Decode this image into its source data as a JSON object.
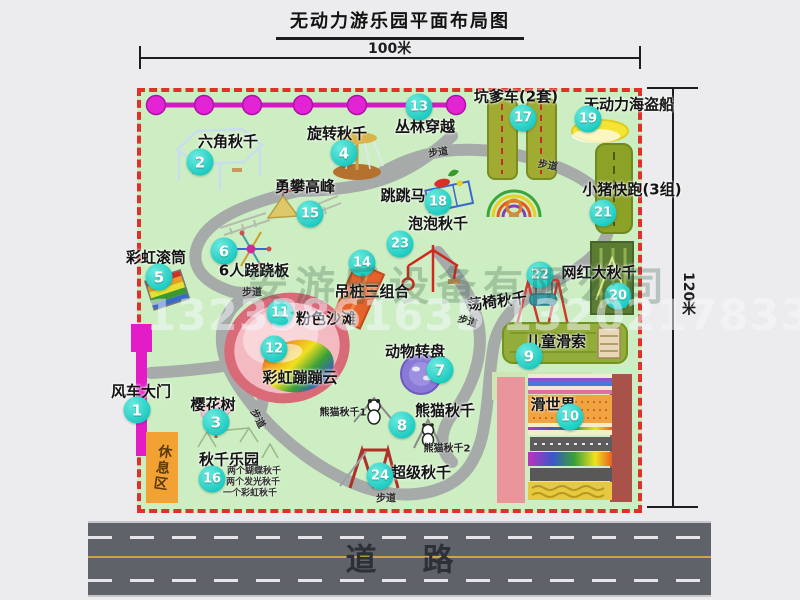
{
  "title": "无动力游乐园平面布局图",
  "dimensions": {
    "top": "100米",
    "right": "120米"
  },
  "road": {
    "label": "道路"
  },
  "rest_area": {
    "label": "休息区"
  },
  "watermark": {
    "company": "安游乐设备有限公司",
    "phones": "13233861635 13202178333"
  },
  "trail_label_text": "步道",
  "trail_labels": [
    {
      "x": 438,
      "y": 151,
      "rot": -8
    },
    {
      "x": 548,
      "y": 164,
      "rot": 10
    },
    {
      "x": 252,
      "y": 291,
      "rot": 0
    },
    {
      "x": 259,
      "y": 418,
      "rot": 62
    },
    {
      "x": 468,
      "y": 320,
      "rot": 18
    },
    {
      "x": 386,
      "y": 497,
      "rot": 0
    }
  ],
  "attractions": [
    {
      "num": "1",
      "label": "风车大门",
      "lx": 141,
      "ly": 391,
      "bx": 137,
      "by": 410
    },
    {
      "num": "2",
      "label": "六角秋千",
      "lx": 228,
      "ly": 141,
      "bx": 200,
      "by": 162
    },
    {
      "num": "3",
      "label": "樱花树",
      "lx": 213,
      "ly": 404,
      "bx": 216,
      "by": 422
    },
    {
      "num": "4",
      "label": "旋转秋千",
      "lx": 337,
      "ly": 133,
      "bx": 344,
      "by": 153
    },
    {
      "num": "5",
      "label": "彩虹滚筒",
      "lx": 156,
      "ly": 257,
      "bx": 159,
      "by": 277
    },
    {
      "num": "6",
      "label": "6人跷跷板",
      "lx": 254,
      "ly": 270,
      "bx": 224,
      "by": 251
    },
    {
      "num": "7",
      "label": "动物转盘",
      "lx": 415,
      "ly": 351,
      "bx": 440,
      "by": 370
    },
    {
      "num": "8",
      "label": "熊猫秋千",
      "lx": 445,
      "ly": 410,
      "bx": 402,
      "by": 425
    },
    {
      "num": "9",
      "label": "儿童滑索",
      "lx": 556,
      "ly": 341,
      "bx": 529,
      "by": 356
    },
    {
      "num": "10",
      "label": "滑世界",
      "lx": 553,
      "ly": 404,
      "bx": 570,
      "by": 417
    },
    {
      "num": "11",
      "label": "粉色沙滩",
      "lx": 326,
      "ly": 318,
      "bx": 280,
      "by": 313
    },
    {
      "num": "12",
      "label": "彩虹蹦蹦云",
      "lx": 300,
      "ly": 377,
      "bx": 274,
      "by": 349
    },
    {
      "num": "13",
      "label": "丛林穿越",
      "lx": 425,
      "ly": 126,
      "bx": 419,
      "by": 107
    },
    {
      "num": "14",
      "label": "吊桩三组合",
      "lx": 372,
      "ly": 291,
      "bx": 362,
      "by": 263
    },
    {
      "num": "15",
      "label": "勇攀高峰",
      "lx": 305,
      "ly": 186,
      "bx": 310,
      "by": 214
    },
    {
      "num": "16",
      "label": "秋千乐园",
      "lx": 229,
      "ly": 459,
      "bx": 212,
      "by": 479
    },
    {
      "num": "17",
      "label": "坑爹车(2套)",
      "lx": 516,
      "ly": 96,
      "bx": 523,
      "by": 118
    },
    {
      "num": "18",
      "label": "跳跳马",
      "lx": 403,
      "ly": 195,
      "bx": 438,
      "by": 202
    },
    {
      "num": "19",
      "label": "无动力海盗船",
      "lx": 629,
      "ly": 104,
      "bx": 588,
      "by": 119
    },
    {
      "num": "20",
      "label": "网红大秋千",
      "lx": 599,
      "ly": 272,
      "bx": 618,
      "by": 296
    },
    {
      "num": "21",
      "label": "小猪快跑(3组)",
      "lx": 632,
      "ly": 189,
      "bx": 603,
      "by": 213
    },
    {
      "num": "22",
      "label": "荡椅秋千",
      "lx": 497,
      "ly": 301,
      "bx": 540,
      "by": 275,
      "rot": -8
    },
    {
      "num": "23",
      "label": "泡泡秋千",
      "lx": 438,
      "ly": 223,
      "bx": 400,
      "by": 244
    },
    {
      "num": "24",
      "label": "超级秋千",
      "lx": 421,
      "ly": 472,
      "bx": 380,
      "by": 476
    }
  ],
  "sub_labels": [
    {
      "text": "熊猫秋千1",
      "x": 343,
      "y": 411
    },
    {
      "text": "熊猫秋千2",
      "x": 447,
      "y": 447
    }
  ],
  "swing_park_notes": [
    {
      "text": "两个蝴蝶秋千",
      "x": 254,
      "y": 470
    },
    {
      "text": "两个发光秋千",
      "x": 253,
      "y": 481
    },
    {
      "text": "一个彩虹秋千",
      "x": 250,
      "y": 492
    }
  ],
  "colors": {
    "badge_teal": "#2BD8CE",
    "border_red": "#E0302A",
    "map_green": "#CDEEC3",
    "road_gray": "#60626A",
    "gate_magenta": "#E41CC8",
    "rest_orange": "#F2A233"
  }
}
